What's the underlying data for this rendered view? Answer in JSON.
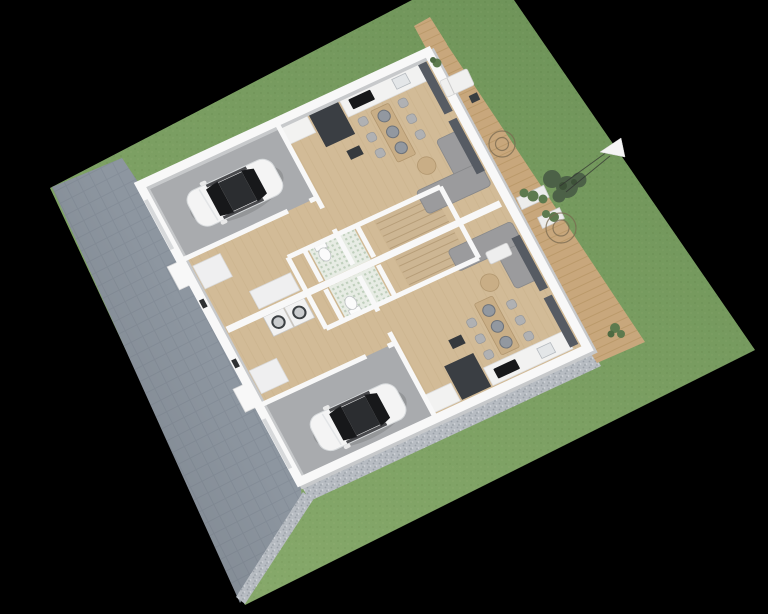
{
  "scene": {
    "description": "Aerial 3D render of a mirrored two-unit residential floor plan on a landscaped plot",
    "units": 2,
    "cars": 2,
    "garages": 2,
    "staircases": 2,
    "bathrooms": 2,
    "dining_tables": 2,
    "sofas": 2,
    "pendant_lamps": 6,
    "dining_chairs": 12,
    "tree_markers": 2
  },
  "colors": {
    "background": "#000000",
    "grass": "#7ca263",
    "driveway": "#8d96a0",
    "gravel": "#b7bcc2",
    "deck_wood": "#c8a77c",
    "floor_wood": "#d2bb97",
    "garage_floor": "#a9abae",
    "wall_white": "#f8f8f8",
    "wall_shade": "#c7c9cb",
    "tile_bath": "#e7ece4",
    "stair_wood": "#cdb693",
    "table_wood": "#c9ae86",
    "cabinet_dark": "#3a3e43",
    "sofa_gray": "#9b9b9d",
    "curtain_dark": "#565b63",
    "pendant_gray": "#9298a0",
    "car_body": "#f4f4f4",
    "car_glass": "#17181a",
    "shrub_green": "#4c6147",
    "plant_green": "#5d7a4e",
    "tree_ring": "#7a6a50",
    "marker_line": "#2f2f2f",
    "arrow_white": "#f5f5f5"
  }
}
